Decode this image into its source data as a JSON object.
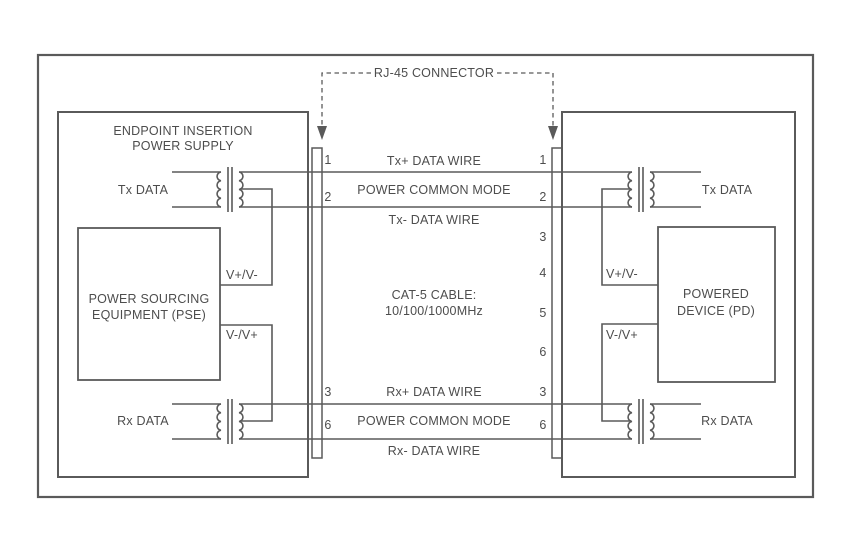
{
  "colors": {
    "line": "#5a5a5a",
    "text": "#4d4d4d"
  },
  "callout": {
    "label": "RJ-45 CONNECTOR"
  },
  "left_unit": {
    "title1": "ENDPOINT INSERTION",
    "title2": "POWER SUPPLY",
    "tx": "Tx DATA",
    "rx": "Rx DATA",
    "pse1": "POWER SOURCING",
    "pse2": "EQUIPMENT (PSE)",
    "v_top": "V+/V-",
    "v_bottom": "V-/V+"
  },
  "right_unit": {
    "tx": "Tx DATA",
    "rx": "Rx DATA",
    "pd1": "POWERED",
    "pd2": "DEVICE (PD)",
    "v_top": "V+/V-",
    "v_bottom": "V-/V+"
  },
  "cable": {
    "name1": "CAT-5 CABLE:",
    "name2": "10/100/1000MHz",
    "tx_plus": "Tx+ DATA WIRE",
    "tx_common": "POWER COMMON MODE",
    "tx_minus": "Tx- DATA WIRE",
    "rx_plus": "Rx+ DATA WIRE",
    "rx_common": "POWER COMMON MODE",
    "rx_minus": "Rx- DATA WIRE"
  },
  "pins": {
    "left": [
      "1",
      "2",
      "3",
      "6"
    ],
    "right": [
      "1",
      "2",
      "3",
      "4",
      "5",
      "6",
      "3",
      "6"
    ]
  }
}
